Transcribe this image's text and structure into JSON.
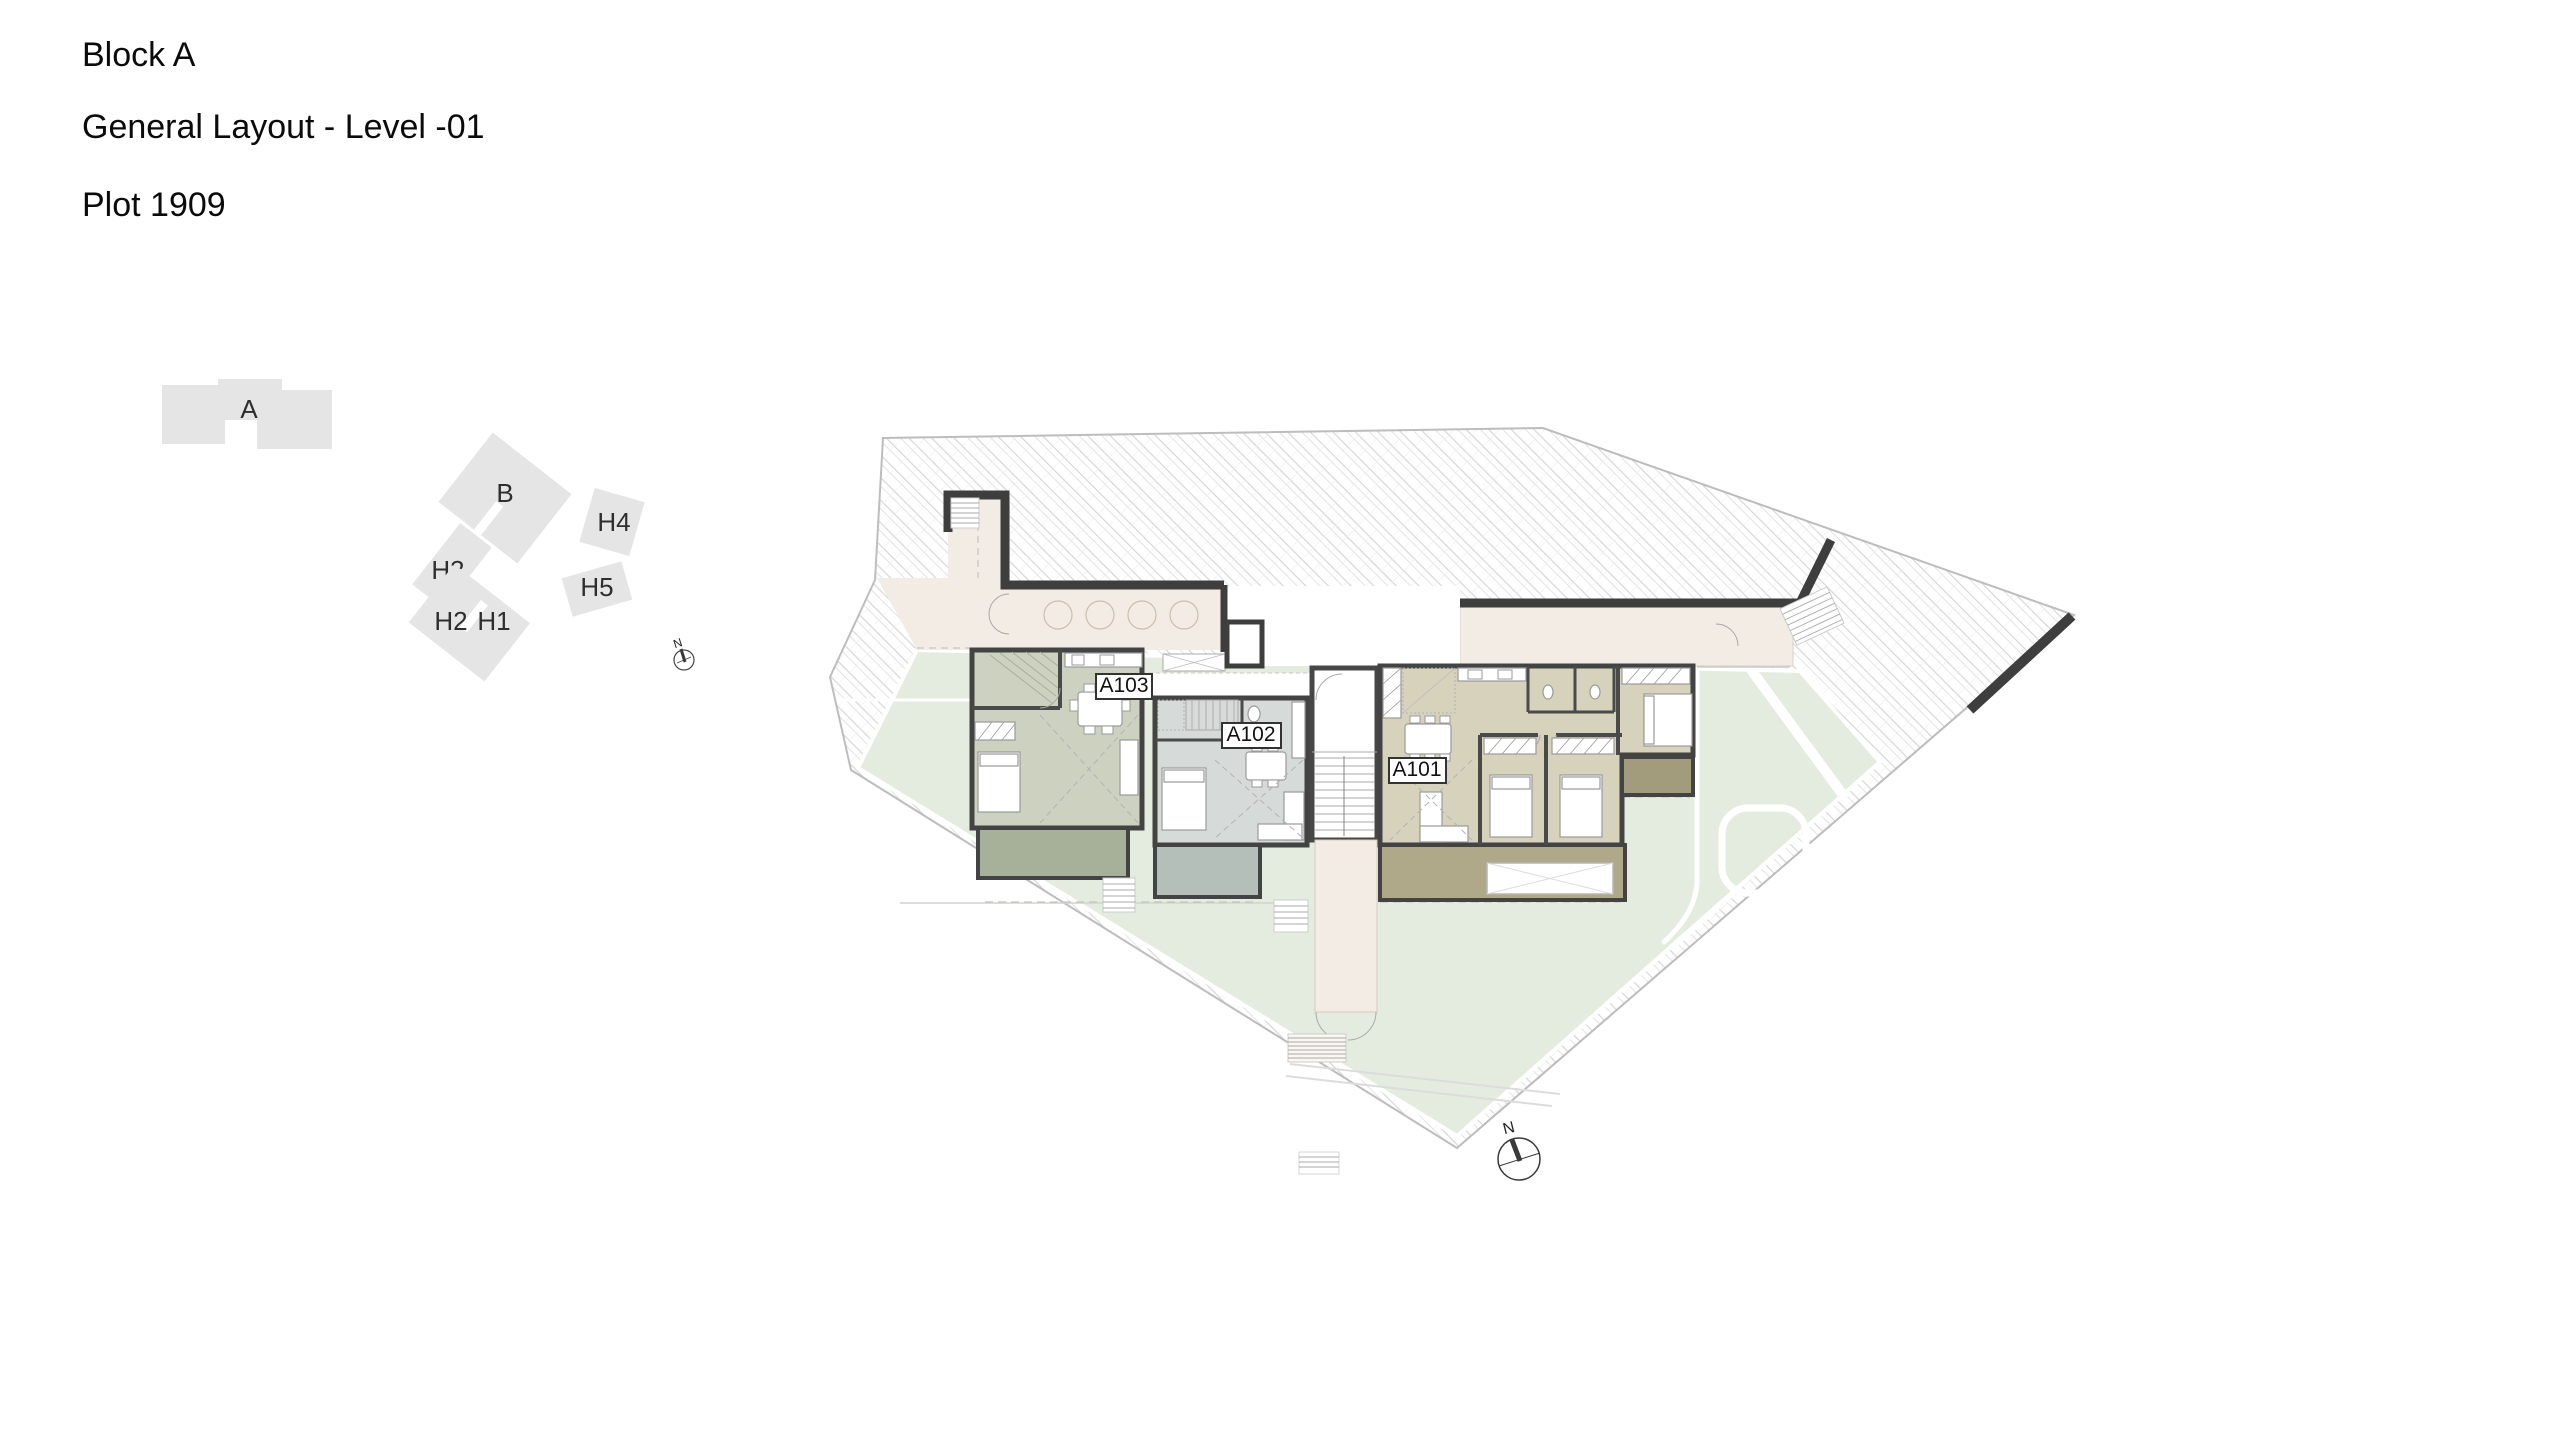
{
  "header": {
    "line1": "Block A",
    "line2": "General Layout - Level -01",
    "line3": "Plot 1909"
  },
  "key_plan": {
    "north_label": "N",
    "buildings": [
      {
        "label": "A"
      },
      {
        "label": "B"
      },
      {
        "label": "H4"
      },
      {
        "label": "H3"
      },
      {
        "label": "H5"
      },
      {
        "label": "H2"
      },
      {
        "label": "H1"
      }
    ]
  },
  "floor_plan": {
    "north_label": "N",
    "units": [
      {
        "label": "A103"
      },
      {
        "label": "A102"
      },
      {
        "label": "A101"
      }
    ]
  },
  "colors": {
    "hatch_line": "#d4d4d4",
    "hatch_line2": "#e3e3e3",
    "boundary": "#bdbdbd",
    "corridor": "#f2ece4",
    "lawn": "#e4ecdf",
    "wall": "#3e3e3e",
    "unit_a103": "#ccd2bf",
    "terrace_a103": "#a7b098",
    "unit_a102": "#d6dbd9",
    "terrace_a102": "#b5bfba",
    "unit_a101": "#d6d2bc",
    "terrace_a101": "#b0a989",
    "terrace_a101_side": "#a29c7c",
    "keyplan_building": "#e5e5e5"
  }
}
